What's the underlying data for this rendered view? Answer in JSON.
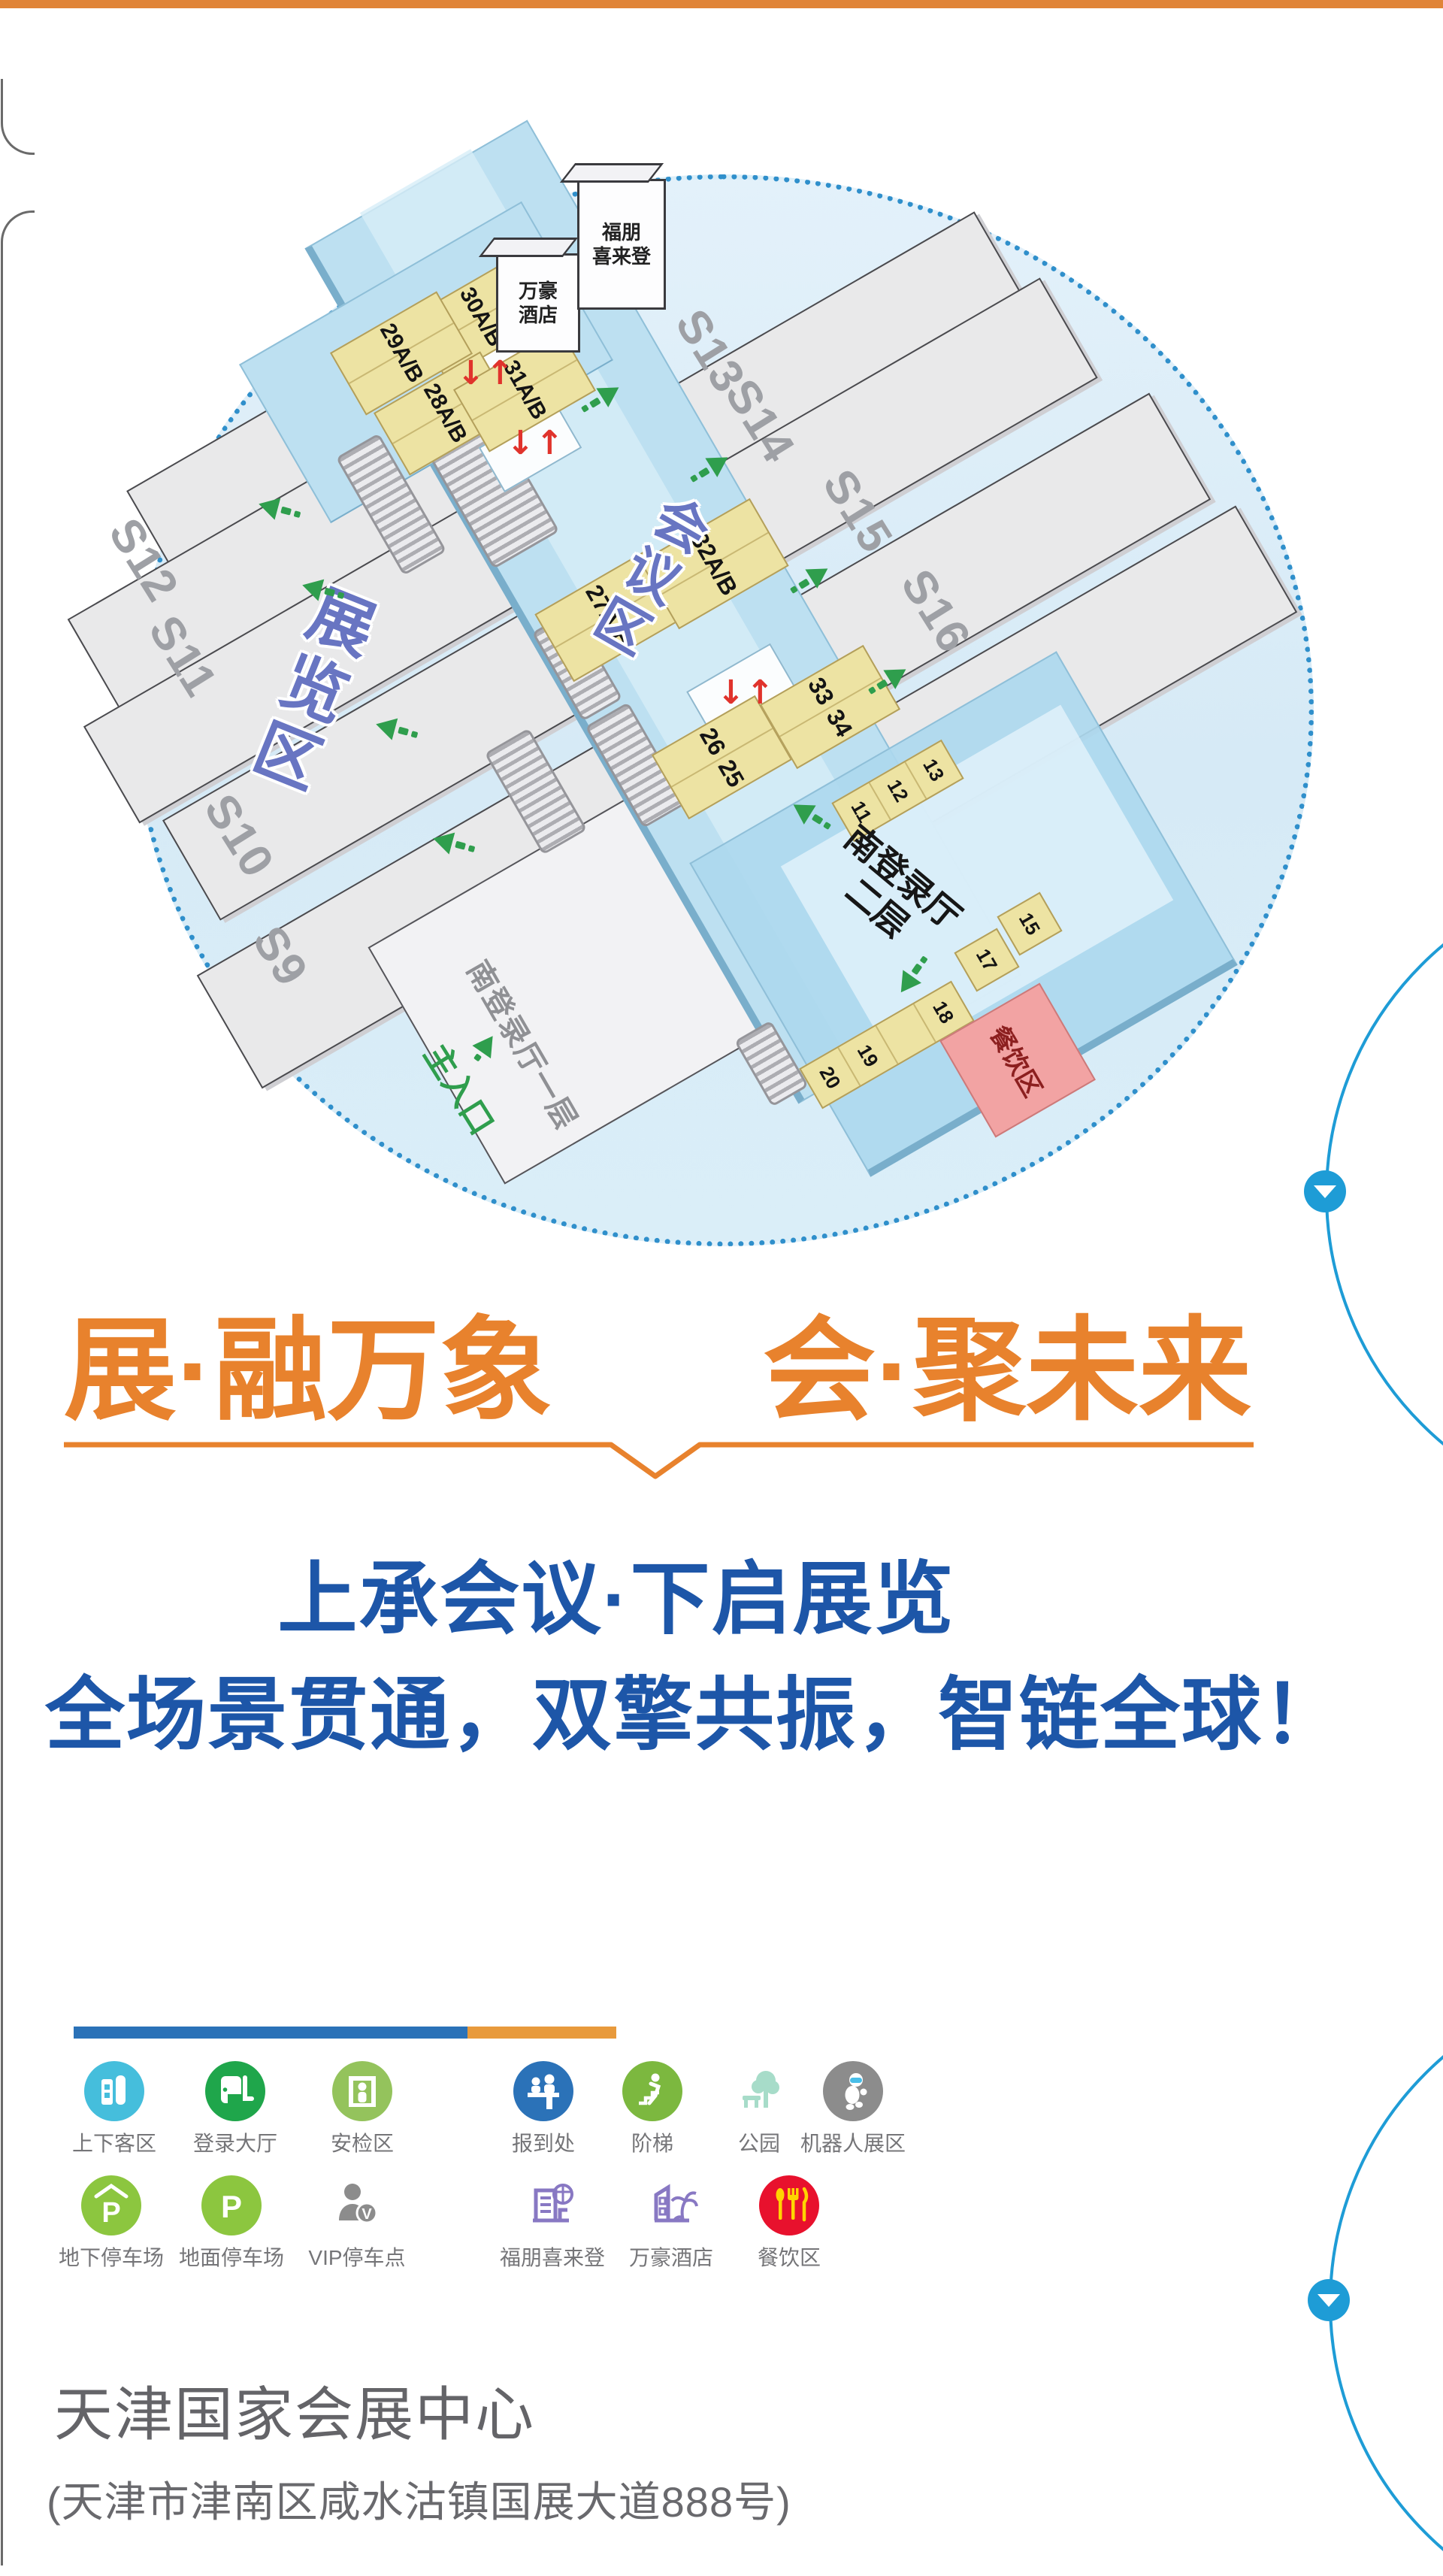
{
  "theme": {
    "accent_orange": "#E8822D",
    "accent_blue": "#1D56A8",
    "map_border_blue": "#2F8FCB",
    "scroll_blue": "#1E9CD6",
    "bar_blue": "#2B72B8",
    "bar_orange": "#E89A3C"
  },
  "map": {
    "hotel_marriott": [
      "万豪",
      "酒店"
    ],
    "hotel_fupeng": [
      "福朋",
      "喜来登"
    ],
    "halls_left": [
      "S12",
      "S11",
      "S10",
      "S9"
    ],
    "halls_right": [
      "S13",
      "S14",
      "S15",
      "S16"
    ],
    "pods": [
      "30A/B",
      "29A/B",
      "28A/B",
      "31A/B",
      "27A/B",
      "32A/B"
    ],
    "pod_pair_33_34": [
      "33",
      "34"
    ],
    "pod_pair_26_25": [
      "26",
      "25"
    ],
    "room_strip_11_13": [
      "11",
      "12",
      "13"
    ],
    "room_15": "15",
    "room_17": "17",
    "room_strip_18_20": [
      "20",
      "19",
      "",
      "18"
    ],
    "region_exhibition": "展览区",
    "region_conference": "会议区",
    "south_hall_l2": [
      "南登录厅",
      "二层"
    ],
    "south_hall_l1": "南登录厅一层",
    "main_entrance": "主入口",
    "dining_zone": "餐饮区"
  },
  "headline": {
    "left": "展·融万象",
    "right": "会·聚未来"
  },
  "slogan": {
    "line1": "上承会议·下启展览",
    "line2": "全场景贯通，双擎共振，智链全球！"
  },
  "legend": {
    "row1": [
      {
        "label": "上下客区",
        "color": "#45BEDC"
      },
      {
        "label": "登录大厅",
        "color": "#1FA64B"
      },
      {
        "label": "安检区",
        "color": "#94C35C"
      },
      {
        "label": "报到处",
        "color": "#2B72B8"
      },
      {
        "label": "阶梯",
        "color": "#7CB83F"
      },
      {
        "label": "公园",
        "color": "#A7DCC9"
      },
      {
        "label": "机器人展区",
        "color": "#8C8C8C"
      }
    ],
    "row2": [
      {
        "label": "地下停车场",
        "color": "#8CC63F"
      },
      {
        "label": "地面停车场",
        "color": "#8CC63F"
      },
      {
        "label": "VIP停车点",
        "color": "#8C8C8C"
      },
      {
        "label": "福朋喜来登",
        "color": "#8878C3"
      },
      {
        "label": "万豪酒店",
        "color": "#8878C3"
      },
      {
        "label": "餐饮区",
        "color": "#E8112D"
      }
    ]
  },
  "footer": {
    "title": "天津国家会展中心",
    "address": "(天津市津南区咸水沽镇国展大道888号)"
  }
}
